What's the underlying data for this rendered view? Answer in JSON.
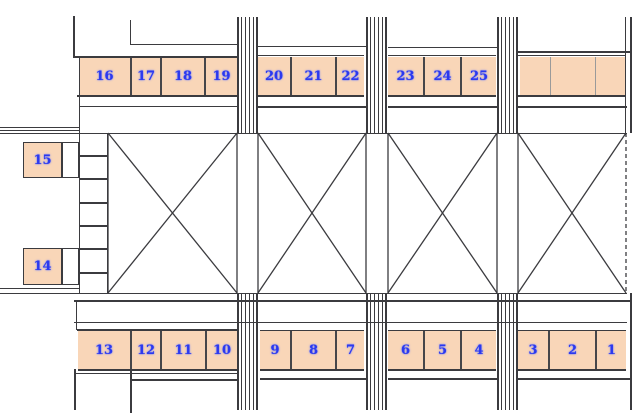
{
  "canvas": {
    "w": 640,
    "h": 419,
    "bg": "#ffffff"
  },
  "colors": {
    "wall": "#3b3b3f",
    "separator_dark": "#46464a",
    "separator_light": "#9a9a9a",
    "stall_fill": "#f9d6b8",
    "annex_fill": "#ffffff",
    "number_blue": "#2c39ee",
    "background": "#ffffff"
  },
  "stalls": {
    "top_row": [
      {
        "label": "16",
        "x": 79,
        "y": 57,
        "w": 51,
        "h": 38
      },
      {
        "label": "17",
        "x": 130,
        "y": 57,
        "w": 30,
        "h": 38
      },
      {
        "label": "18",
        "x": 160,
        "y": 57,
        "w": 44,
        "h": 38
      },
      {
        "label": "19",
        "x": 204,
        "y": 57,
        "w": 33,
        "h": 38
      },
      {
        "label": "20",
        "x": 258,
        "y": 57,
        "w": 32,
        "h": 38
      },
      {
        "label": "21",
        "x": 290,
        "y": 57,
        "w": 45,
        "h": 38
      },
      {
        "label": "22",
        "x": 335,
        "y": 57,
        "w": 29,
        "h": 38
      },
      {
        "label": "23",
        "x": 388,
        "y": 57,
        "w": 35,
        "h": 38
      },
      {
        "label": "24",
        "x": 423,
        "y": 57,
        "w": 37,
        "h": 38
      },
      {
        "label": "25",
        "x": 460,
        "y": 57,
        "w": 36,
        "h": 38
      },
      {
        "label": "",
        "x": 520,
        "y": 57,
        "w": 30,
        "h": 38,
        "sep": "light"
      },
      {
        "label": "",
        "x": 550,
        "y": 57,
        "w": 45,
        "h": 38,
        "sep": "light"
      },
      {
        "label": "",
        "x": 595,
        "y": 57,
        "w": 31,
        "h": 38,
        "sep": "light"
      }
    ],
    "bottom_row": [
      {
        "label": "13",
        "x": 78,
        "y": 331,
        "w": 52,
        "h": 38
      },
      {
        "label": "12",
        "x": 130,
        "y": 331,
        "w": 30,
        "h": 38
      },
      {
        "label": "11",
        "x": 160,
        "y": 331,
        "w": 45,
        "h": 38
      },
      {
        "label": "10",
        "x": 205,
        "y": 331,
        "w": 32,
        "h": 38
      },
      {
        "label": "9",
        "x": 260,
        "y": 331,
        "w": 30,
        "h": 38
      },
      {
        "label": "8",
        "x": 290,
        "y": 331,
        "w": 45,
        "h": 38
      },
      {
        "label": "7",
        "x": 335,
        "y": 331,
        "w": 29,
        "h": 38
      },
      {
        "label": "6",
        "x": 388,
        "y": 331,
        "w": 35,
        "h": 38
      },
      {
        "label": "5",
        "x": 423,
        "y": 331,
        "w": 37,
        "h": 38
      },
      {
        "label": "4",
        "x": 460,
        "y": 331,
        "w": 36,
        "h": 38
      },
      {
        "label": "3",
        "x": 518,
        "y": 331,
        "w": 30,
        "h": 38
      },
      {
        "label": "2",
        "x": 548,
        "y": 331,
        "w": 47,
        "h": 38
      },
      {
        "label": "1",
        "x": 595,
        "y": 331,
        "w": 31,
        "h": 38
      }
    ],
    "left_column": [
      {
        "label": "15",
        "x": 23,
        "y": 142,
        "w": 39,
        "h": 36
      },
      {
        "label": "14",
        "x": 23,
        "y": 248,
        "w": 39,
        "h": 37
      }
    ],
    "annex_cells": [
      {
        "x": 62,
        "y": 142,
        "w": 17,
        "h": 36
      },
      {
        "x": 62,
        "y": 248,
        "w": 17,
        "h": 37
      }
    ]
  },
  "walls": {
    "horizontal": [
      [
        73,
        56,
        164,
        2
      ],
      [
        130,
        44,
        107,
        1
      ],
      [
        258,
        46,
        108,
        1
      ],
      [
        388,
        47,
        109,
        1
      ],
      [
        518,
        51,
        113,
        2
      ],
      [
        258,
        55,
        106,
        1
      ],
      [
        388,
        55,
        108,
        1
      ],
      [
        518,
        55,
        108,
        1
      ],
      [
        77,
        95,
        160,
        2
      ],
      [
        258,
        95,
        106,
        2
      ],
      [
        388,
        95,
        108,
        2
      ],
      [
        518,
        95,
        108,
        2
      ],
      [
        79,
        106,
        158,
        1
      ],
      [
        258,
        106,
        108,
        2
      ],
      [
        388,
        106,
        109,
        2
      ],
      [
        518,
        106,
        109,
        2
      ],
      [
        0,
        127,
        79,
        1
      ],
      [
        0,
        130,
        79,
        1
      ],
      [
        0,
        133,
        627,
        1
      ],
      [
        0,
        288,
        79,
        1
      ],
      [
        0,
        293,
        627,
        1
      ],
      [
        74,
        300,
        557,
        2
      ],
      [
        74,
        322,
        553,
        1
      ],
      [
        77,
        329,
        160,
        2
      ],
      [
        260,
        330,
        104,
        1
      ],
      [
        388,
        330,
        108,
        1
      ],
      [
        518,
        330,
        108,
        1
      ],
      [
        78,
        369,
        159,
        2
      ],
      [
        260,
        369,
        104,
        2
      ],
      [
        388,
        369,
        108,
        2
      ],
      [
        518,
        369,
        108,
        2
      ],
      [
        74,
        373,
        163,
        1
      ],
      [
        130,
        379,
        107,
        2
      ],
      [
        260,
        378,
        106,
        2
      ],
      [
        388,
        378,
        109,
        2
      ],
      [
        518,
        378,
        112,
        2
      ],
      [
        79,
        155,
        28,
        2
      ],
      [
        79,
        178,
        28,
        2
      ],
      [
        79,
        202,
        28,
        2
      ],
      [
        79,
        225,
        28,
        2
      ],
      [
        79,
        248,
        28,
        2
      ],
      [
        79,
        272,
        28,
        2
      ]
    ],
    "vertical": [
      [
        73,
        16,
        41,
        2
      ],
      [
        130,
        20,
        24,
        1
      ],
      [
        79,
        56,
        77,
        1
      ],
      [
        625,
        17,
        116,
        1
      ],
      [
        630,
        17,
        116,
        2
      ],
      [
        79,
        133,
        160,
        1
      ],
      [
        107,
        133,
        160,
        1
      ],
      [
        76,
        300,
        30,
        1
      ],
      [
        74,
        369,
        41,
        2
      ],
      [
        130,
        369,
        44,
        2
      ],
      [
        630,
        293,
        117,
        2
      ]
    ]
  },
  "pillars": {
    "width": 21,
    "stripes": [
      [
        0,
        2
      ],
      [
        4,
        1
      ],
      [
        8,
        1
      ],
      [
        12,
        1
      ],
      [
        16,
        1
      ],
      [
        19,
        2
      ]
    ],
    "positions": [
      {
        "x": 237,
        "y": 17,
        "h": 116
      },
      {
        "x": 366,
        "y": 17,
        "h": 116
      },
      {
        "x": 497,
        "y": 17,
        "h": 116
      },
      {
        "x": 237,
        "y": 293,
        "h": 117
      },
      {
        "x": 366,
        "y": 293,
        "h": 117
      },
      {
        "x": 497,
        "y": 293,
        "h": 117
      }
    ]
  },
  "bays": [
    {
      "id": "bay-1",
      "x": 108,
      "y": 133,
      "w": 129,
      "h": 160,
      "dashed_right": false
    },
    {
      "id": "bay-2",
      "x": 258,
      "y": 133,
      "w": 108,
      "h": 160,
      "dashed_right": false
    },
    {
      "id": "bay-3",
      "x": 388,
      "y": 133,
      "w": 109,
      "h": 160,
      "dashed_right": false
    },
    {
      "id": "bay-4",
      "x": 518,
      "y": 133,
      "w": 108,
      "h": 160,
      "dashed_right": true
    }
  ]
}
